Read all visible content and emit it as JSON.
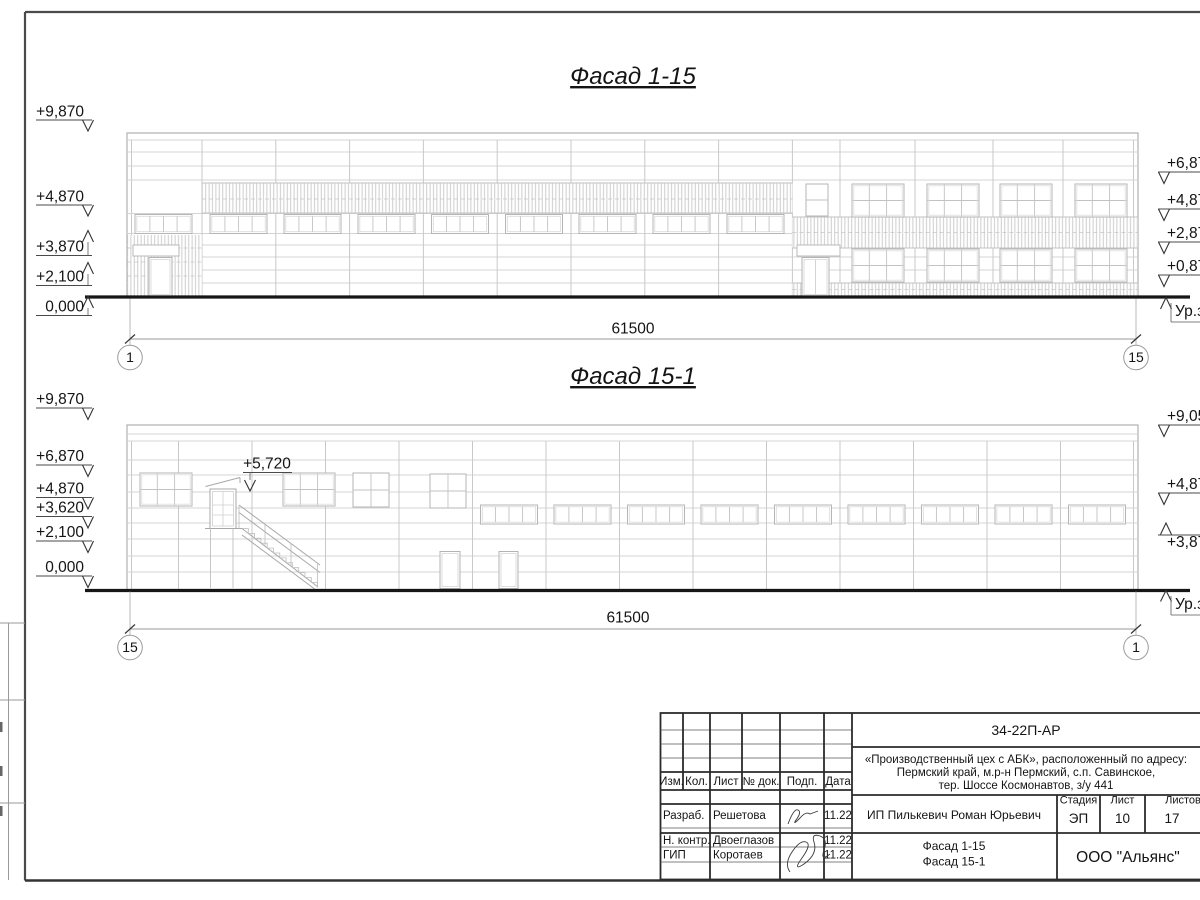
{
  "facade1": {
    "title": "Фасад 1-15",
    "levels_left": [
      "+9,870",
      "+4,870",
      "+3,870",
      "+2,100",
      "0,000"
    ],
    "levels_right": [
      "+6,87",
      "+4,87",
      "+2,87",
      "+0,87"
    ],
    "ground_label": "Ур.зе",
    "dimension": "61500",
    "axis_left": "1",
    "axis_right": "15"
  },
  "facade2": {
    "title": "Фасад 15-1",
    "levels_left": [
      "+9,870",
      "+6,870",
      "+4,870",
      "+3,620",
      "+2,100",
      "0,000"
    ],
    "levels_right": [
      "+9,05",
      "+4,87",
      "+3,87"
    ],
    "door_mark": "+5,720",
    "ground_label": "Ур.зе",
    "dimension": "61500",
    "axis_left": "15",
    "axis_right": "1"
  },
  "titleblock": {
    "doc_number": "34-22П-АР",
    "project_line1": "«Производственный цех с АБК», расположенный по адресу:",
    "project_line2": "Пермский край, м.р-н Пермский, с.п. Савинское,",
    "project_line3": "тер. Шоссе Космонавтов, з/у 441",
    "change_headers": [
      "Изм.",
      "Кол.",
      "Лист",
      "№ док.",
      "Подп.",
      "Дата"
    ],
    "stage_label": "Стадия",
    "sheet_label": "Лист",
    "sheets_label": "Листов",
    "stage": "ЭП",
    "sheet": "10",
    "sheets": "17",
    "client": "ИП Пилькевич Роман Юрьевич",
    "sheet_name1": "Фасад 1-15",
    "sheet_name2": "Фасад 15-1",
    "org": "ООО \"Альянс\"",
    "rows": [
      {
        "role": "Разраб.",
        "name": "Решетова",
        "date": "11.22"
      },
      {
        "role": "Н. контр.",
        "name": "Двоеглазов",
        "date": "11.22"
      },
      {
        "role": "ГИП",
        "name": "Коротаев",
        "date": "11.22"
      }
    ]
  }
}
